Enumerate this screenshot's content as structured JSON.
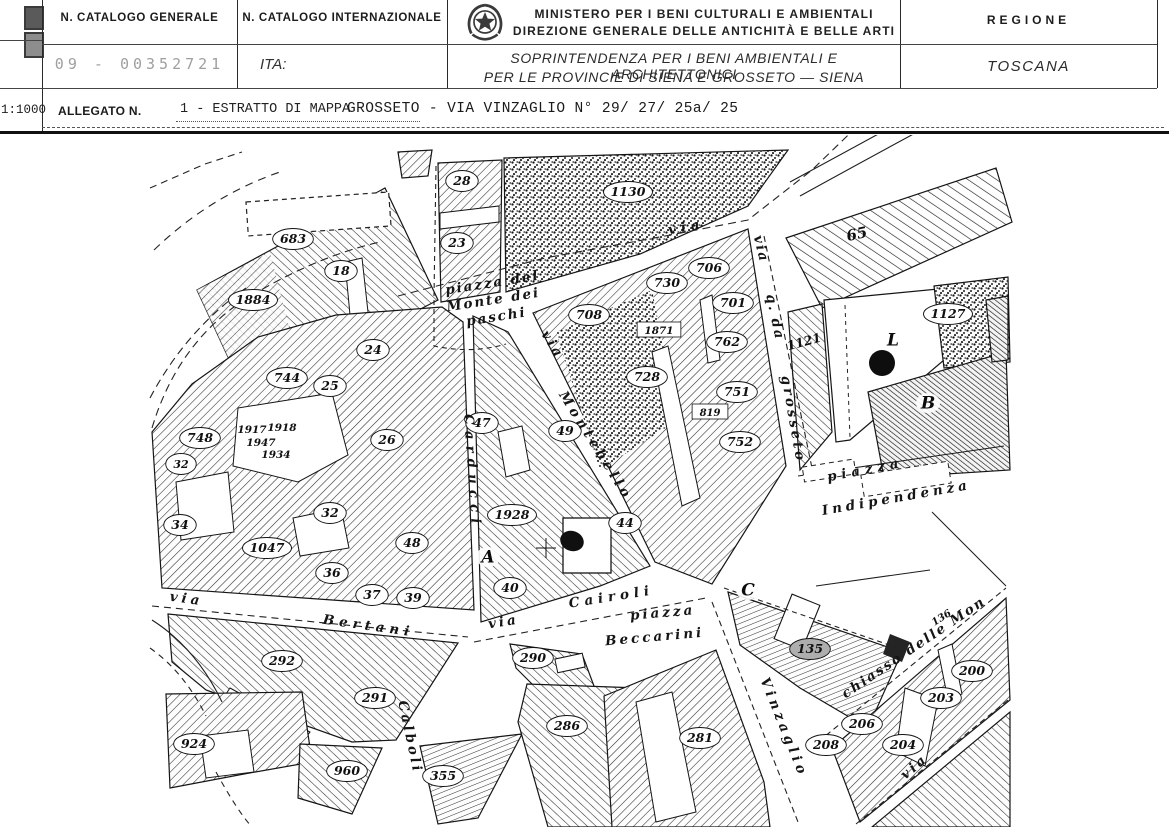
{
  "header": {
    "scale": "1:1000",
    "catalogo_generale": {
      "label": "N. CATALOGO GENERALE",
      "value": "09 - 00352721"
    },
    "catalogo_internazionale": {
      "label": "N. CATALOGO INTERNAZIONALE",
      "value": "ITA:"
    },
    "ministry": {
      "line1": "MINISTERO PER I BENI CULTURALI E AMBIENTALI",
      "line2": "DIREZIONE GENERALE DELLE ANTICHITÀ E BELLE ARTI"
    },
    "soprintendenza": {
      "line1": "SOPRINTENDENZA PER I BENI AMBIENTALI E ARCHITETTONICI",
      "line2": "PER LE PROVINCIE DI SIENA E GROSSETO — SIENA"
    },
    "regione": {
      "label": "REGIONE",
      "value": "TOSCANA"
    },
    "allegato": {
      "label": "ALLEGATO N.",
      "value": "1 - ESTRATTO DI MAPPA"
    },
    "location": "GROSSETO - VIA VINZAGLIO N° 29/ 27/ 25a/ 25"
  },
  "map": {
    "highlight_color": "#aeaeae",
    "parcels": [
      {
        "t": "683",
        "x": 293,
        "y": 239
      },
      {
        "t": "18",
        "x": 341,
        "y": 271
      },
      {
        "t": "1884",
        "x": 253,
        "y": 300
      },
      {
        "t": "28",
        "x": 462,
        "y": 181
      },
      {
        "t": "23",
        "x": 457,
        "y": 243
      },
      {
        "t": "1130",
        "x": 628,
        "y": 192
      },
      {
        "t": "65",
        "x": 857,
        "y": 235,
        "r": -12,
        "bg": "none",
        "s": 15
      },
      {
        "t": "24",
        "x": 373,
        "y": 350
      },
      {
        "t": "744",
        "x": 287,
        "y": 378
      },
      {
        "t": "25",
        "x": 330,
        "y": 386
      },
      {
        "t": "748",
        "x": 200,
        "y": 438
      },
      {
        "t": "1917",
        "x": 252,
        "y": 429,
        "bg": "none",
        "s": 10.5
      },
      {
        "t": "1918",
        "x": 282,
        "y": 427,
        "bg": "none",
        "s": 10.5
      },
      {
        "t": "1947",
        "x": 261,
        "y": 442,
        "bg": "none",
        "s": 10.5
      },
      {
        "t": "1934",
        "x": 276,
        "y": 454,
        "bg": "none",
        "s": 10.5
      },
      {
        "t": "34",
        "x": 180,
        "y": 525
      },
      {
        "t": "32",
        "x": 181,
        "y": 464,
        "s": 11
      },
      {
        "t": "26",
        "x": 387,
        "y": 440
      },
      {
        "t": "47",
        "x": 482,
        "y": 423
      },
      {
        "t": "49",
        "x": 565,
        "y": 431
      },
      {
        "t": "1928",
        "x": 512,
        "y": 515
      },
      {
        "t": "48",
        "x": 412,
        "y": 543
      },
      {
        "t": "32",
        "x": 330,
        "y": 513
      },
      {
        "t": "1047",
        "x": 267,
        "y": 548
      },
      {
        "t": "36",
        "x": 332,
        "y": 573
      },
      {
        "t": "37",
        "x": 372,
        "y": 595
      },
      {
        "t": "39",
        "x": 413,
        "y": 598
      },
      {
        "t": "40",
        "x": 510,
        "y": 588
      },
      {
        "t": "44",
        "x": 625,
        "y": 523
      },
      {
        "t": "708",
        "x": 589,
        "y": 315
      },
      {
        "t": "730",
        "x": 667,
        "y": 283
      },
      {
        "t": "706",
        "x": 709,
        "y": 268
      },
      {
        "t": "701",
        "x": 733,
        "y": 303
      },
      {
        "t": "1871",
        "x": 659,
        "y": 330,
        "bg": "rect",
        "s": 10.5
      },
      {
        "t": "762",
        "x": 727,
        "y": 342
      },
      {
        "t": "728",
        "x": 647,
        "y": 377
      },
      {
        "t": "751",
        "x": 737,
        "y": 392
      },
      {
        "t": "819",
        "x": 710,
        "y": 412,
        "bg": "rect",
        "s": 10
      },
      {
        "t": "752",
        "x": 740,
        "y": 442
      },
      {
        "t": "1121",
        "x": 804,
        "y": 342,
        "r": -15,
        "bg": "none",
        "s": 12.5
      },
      {
        "t": "1127",
        "x": 948,
        "y": 314
      },
      {
        "t": "292",
        "x": 282,
        "y": 661
      },
      {
        "t": "291",
        "x": 375,
        "y": 698
      },
      {
        "t": "924",
        "x": 194,
        "y": 744
      },
      {
        "t": "960",
        "x": 347,
        "y": 771
      },
      {
        "t": "355",
        "x": 443,
        "y": 776
      },
      {
        "t": "290",
        "x": 533,
        "y": 658
      },
      {
        "t": "286",
        "x": 567,
        "y": 726
      },
      {
        "t": "281",
        "x": 700,
        "y": 738
      },
      {
        "t": "135",
        "x": 810,
        "y": 649,
        "bg": "gray"
      },
      {
        "t": "136",
        "x": 941,
        "y": 617,
        "r": -33,
        "bg": "none",
        "s": 10
      },
      {
        "t": "208",
        "x": 826,
        "y": 745
      },
      {
        "t": "206",
        "x": 862,
        "y": 724
      },
      {
        "t": "204",
        "x": 903,
        "y": 745
      },
      {
        "t": "203",
        "x": 941,
        "y": 698
      },
      {
        "t": "200",
        "x": 972,
        "y": 671
      }
    ],
    "streets": [
      {
        "t": "via",
        "x": 687,
        "y": 231,
        "r": -10,
        "ls": 5
      },
      {
        "t": "piazza del",
        "x": 493,
        "y": 287,
        "r": -9,
        "ls": 2
      },
      {
        "t": "Monte dei",
        "x": 494,
        "y": 304,
        "r": -9,
        "ls": 2
      },
      {
        "t": "paschi",
        "x": 497,
        "y": 321,
        "r": -9,
        "ls": 2
      },
      {
        "t": "via",
        "x": 549,
        "y": 347,
        "r": 58,
        "ls": 3
      },
      {
        "t": "Montebello",
        "x": 592,
        "y": 448,
        "r": 58,
        "ls": 4
      },
      {
        "t": "Carducci",
        "x": 468,
        "y": 472,
        "r": 86,
        "ls": 6
      },
      {
        "t": "via",
        "x": 757,
        "y": 250,
        "r": 76,
        "ls": 2
      },
      {
        "t": "q. da",
        "x": 771,
        "y": 318,
        "r": 78,
        "ls": 2
      },
      {
        "t": "grosseto",
        "x": 789,
        "y": 420,
        "r": 80,
        "ls": 3
      },
      {
        "t": "via",
        "x": 186,
        "y": 603,
        "r": 8,
        "ls": 4
      },
      {
        "t": "Bertani",
        "x": 368,
        "y": 630,
        "r": 8,
        "ls": 5
      },
      {
        "t": "via",
        "x": 504,
        "y": 626,
        "r": -9,
        "ls": 3
      },
      {
        "t": "Cairoli",
        "x": 612,
        "y": 601,
        "r": -9,
        "ls": 5
      },
      {
        "t": "Calboli",
        "x": 406,
        "y": 738,
        "r": 78,
        "ls": 3
      },
      {
        "t": "piazza",
        "x": 663,
        "y": 617,
        "r": -5,
        "ls": 3
      },
      {
        "t": "Beccarini",
        "x": 655,
        "y": 641,
        "r": -5,
        "ls": 3
      },
      {
        "t": "Vinzaglio",
        "x": 780,
        "y": 729,
        "r": 68,
        "ls": 4
      },
      {
        "t": "piazza",
        "x": 866,
        "y": 474,
        "r": -11,
        "ls": 5
      },
      {
        "t": "Indipendenza",
        "x": 897,
        "y": 502,
        "r": -10,
        "ls": 4
      },
      {
        "t": "chiasso delle Mon",
        "x": 916,
        "y": 651,
        "r": -34,
        "ls": 2
      },
      {
        "t": "via",
        "x": 917,
        "y": 770,
        "r": -40,
        "ls": 3
      }
    ],
    "letters": [
      {
        "t": "A",
        "x": 488,
        "y": 557
      },
      {
        "t": "B",
        "x": 928,
        "y": 403
      },
      {
        "t": "C",
        "x": 748,
        "y": 590
      },
      {
        "t": "L",
        "x": 893,
        "y": 340
      }
    ]
  }
}
